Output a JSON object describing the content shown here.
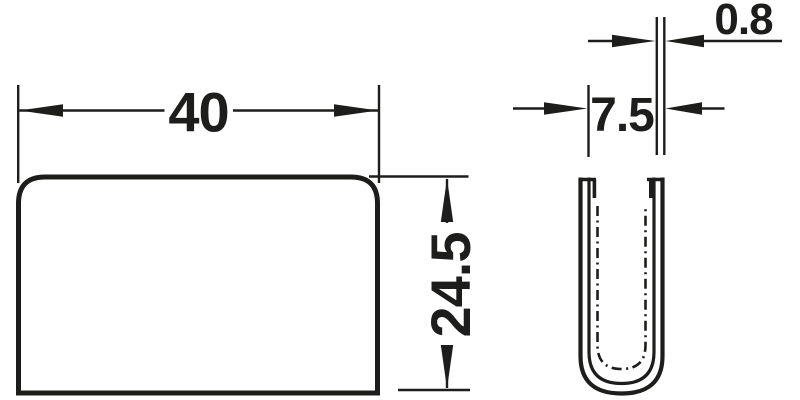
{
  "drawing": {
    "background_color": "#ffffff",
    "line_color": "#1d1d1b",
    "front_view": {
      "width_dim": "40",
      "height_dim": "24.5"
    },
    "profile_view": {
      "width_dim": "7.5",
      "wall_thickness_dim": "0.8"
    }
  }
}
